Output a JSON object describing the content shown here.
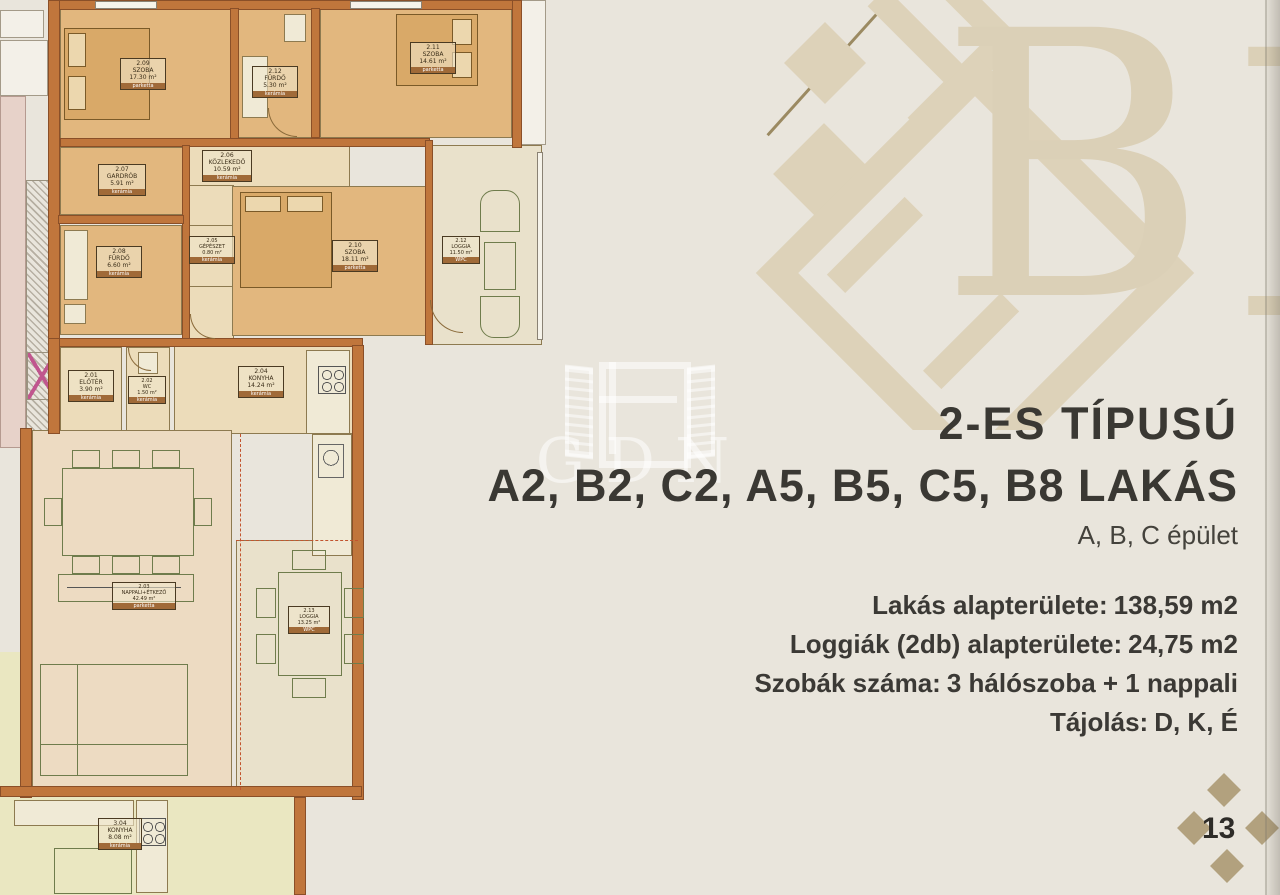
{
  "header": {
    "title_line1": "2-ES TÍPUSÚ",
    "title_line2": "A2, B2, C2, A5, B5, C5, B8 LAKÁS",
    "building": "A, B, C épület"
  },
  "details": [
    {
      "label": "Lakás alapterülete:",
      "value": "138,59 m2"
    },
    {
      "label": "Loggiák (2db) alapterülete:",
      "value": "24,75 m2"
    },
    {
      "label": "Szobák száma:",
      "value": "3 hálószoba + 1 nappali"
    },
    {
      "label": "Tájolás:",
      "value": "D, K, É"
    }
  ],
  "watermark": {
    "letter": "B",
    "agency_logo_text": "GDN"
  },
  "footer": {
    "page_number": "13"
  },
  "plan": {
    "rooms": [
      {
        "no": "2.09",
        "name": "SZOBA",
        "area": "17.30 m²",
        "floor": "parketta"
      },
      {
        "no": "2.12",
        "name": "FÜRDŐ",
        "area": "5.30 m²",
        "floor": "kerámia"
      },
      {
        "no": "2.11",
        "name": "SZOBA",
        "area": "14.61 m²",
        "floor": "parketta"
      },
      {
        "no": "2.07",
        "name": "GARDRÓB",
        "area": "5.91 m²",
        "floor": "kerámia"
      },
      {
        "no": "2.06",
        "name": "KÖZLEKEDŐ",
        "area": "10.59 m²",
        "floor": "kerámia"
      },
      {
        "no": "2.08",
        "name": "FÜRDŐ",
        "area": "6.60 m²",
        "floor": "kerámia"
      },
      {
        "no": "2.05",
        "name": "GÉPÉSZET",
        "area": "0.80 m²",
        "floor": "kerámia"
      },
      {
        "no": "2.10",
        "name": "SZOBA",
        "area": "18.11 m²",
        "floor": "parketta"
      },
      {
        "no": "2.12",
        "name": "LOGGIA",
        "area": "11.50 m²",
        "floor": "WPC"
      },
      {
        "no": "2.01",
        "name": "ELŐTÉR",
        "area": "3.90 m²",
        "floor": "kerámia"
      },
      {
        "no": "2.02",
        "name": "WC",
        "area": "1.50 m²",
        "floor": "kerámia"
      },
      {
        "no": "2.04",
        "name": "KONYHA",
        "area": "14.24 m²",
        "floor": "kerámia"
      },
      {
        "no": "2.03",
        "name": "NAPPALI+ÉTKEZŐ",
        "area": "42.49 m²",
        "floor": "parketta"
      },
      {
        "no": "2.13",
        "name": "LOGGIA",
        "area": "13.25 m²",
        "floor": "WPC"
      },
      {
        "no": "3.04",
        "name": "KONYHA",
        "area": "8.08 m²",
        "floor": "kerámia"
      }
    ]
  },
  "colors": {
    "page_bg": "#e9e5dc",
    "wall_orange": "#c0763c",
    "room_tan": "#e2b77e",
    "watermark_beige": "#dbd0b7",
    "accent_gold": "#9b8a62",
    "diamond_beige": "#b2a17e",
    "text_dark": "#3a3833"
  }
}
